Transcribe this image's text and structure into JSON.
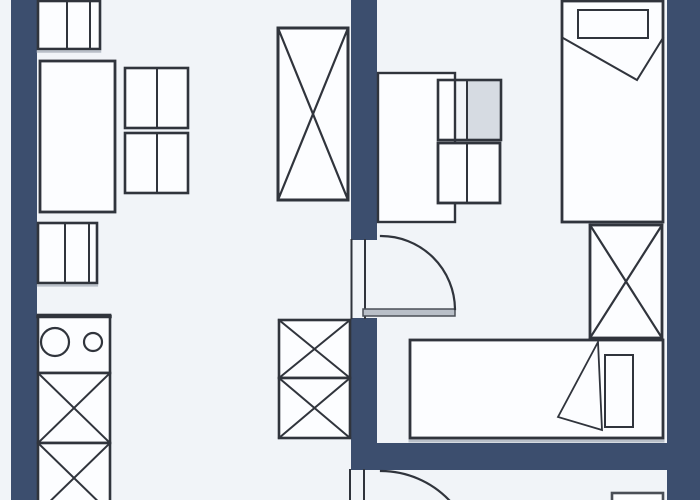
{
  "floorplan": {
    "canvas": {
      "width": 700,
      "height": 500
    },
    "palette": {
      "background": "#f1f4f8",
      "wall": "#3c4e6e",
      "line": "#30343c",
      "line_soft": "#4a4f57",
      "paper": "#fcfdff",
      "shade": "#b9bfc8",
      "cell_shade": "#d6dbe2"
    },
    "elements": [
      {
        "name": "wall-left",
        "kind": "rect",
        "x": 11,
        "y": 0,
        "w": 26,
        "h": 500,
        "fill": "wall",
        "stroke": "none"
      },
      {
        "name": "wall-middle-upper",
        "kind": "rect",
        "x": 351,
        "y": 0,
        "w": 26,
        "h": 240,
        "fill": "wall",
        "stroke": "none"
      },
      {
        "name": "wall-middle-lower",
        "kind": "rect",
        "x": 351,
        "y": 318,
        "w": 26,
        "h": 127,
        "fill": "wall",
        "stroke": "none"
      },
      {
        "name": "wall-bottom",
        "kind": "rect",
        "x": 351,
        "y": 443,
        "w": 349,
        "h": 27,
        "fill": "wall",
        "stroke": "none"
      },
      {
        "name": "wall-right",
        "kind": "rect",
        "x": 667,
        "y": 0,
        "w": 33,
        "h": 500,
        "fill": "wall",
        "stroke": "none"
      },
      {
        "name": "cabinet-top",
        "kind": "rect",
        "x": 38,
        "y": 1,
        "w": 62,
        "h": 48,
        "fill": "paper",
        "sw": 2.6
      },
      {
        "name": "cabinet-top-divider-1",
        "kind": "line",
        "x1": 67,
        "y1": 1,
        "x2": 67,
        "y2": 49,
        "sw": 2
      },
      {
        "name": "cabinet-top-divider-2",
        "kind": "line",
        "x1": 90,
        "y1": 1,
        "x2": 90,
        "y2": 49,
        "sw": 2
      },
      {
        "name": "cabinet-top-shadow",
        "kind": "line",
        "x1": 38,
        "y1": 51.5,
        "x2": 100,
        "y2": 51.5,
        "stroke": "shade",
        "sw": 2.5
      },
      {
        "name": "sofa-table-large",
        "kind": "rect",
        "x": 40,
        "y": 61,
        "w": 75,
        "h": 151,
        "fill": "paper",
        "sw": 2.8
      },
      {
        "name": "side-table-1",
        "kind": "rect",
        "x": 125,
        "y": 68,
        "w": 63,
        "h": 60,
        "fill": "paper",
        "sw": 2.6
      },
      {
        "name": "side-table-1-divider",
        "kind": "line",
        "x1": 157,
        "y1": 68,
        "x2": 157,
        "y2": 128,
        "sw": 2
      },
      {
        "name": "side-table-2",
        "kind": "rect",
        "x": 125,
        "y": 133,
        "w": 63,
        "h": 60,
        "fill": "paper",
        "sw": 2.6
      },
      {
        "name": "side-table-2-divider",
        "kind": "line",
        "x1": 157,
        "y1": 133,
        "x2": 157,
        "y2": 193,
        "sw": 2
      },
      {
        "name": "cabinet-mid",
        "kind": "rect",
        "x": 38,
        "y": 223,
        "w": 59,
        "h": 60,
        "fill": "paper",
        "sw": 2.6
      },
      {
        "name": "cabinet-mid-divider-1",
        "kind": "line",
        "x1": 65,
        "y1": 223,
        "x2": 65,
        "y2": 283,
        "sw": 2
      },
      {
        "name": "cabinet-mid-divider-2",
        "kind": "line",
        "x1": 89,
        "y1": 223,
        "x2": 89,
        "y2": 283,
        "sw": 2
      },
      {
        "name": "cabinet-mid-shadow",
        "kind": "line",
        "x1": 38,
        "y1": 285.5,
        "x2": 97,
        "y2": 285.5,
        "stroke": "shade",
        "sw": 2.2
      },
      {
        "name": "sink-counter",
        "kind": "rect",
        "x": 38,
        "y": 315,
        "w": 72,
        "h": 58,
        "fill": "paper",
        "sw": 2.6
      },
      {
        "name": "sink-counter-top-edge",
        "kind": "line",
        "x1": 38,
        "y1": 316.5,
        "x2": 110,
        "y2": 316.5,
        "sw": 3.5
      },
      {
        "name": "sink-basin-large",
        "kind": "circle",
        "cx": 55,
        "cy": 342,
        "r": 14,
        "sw": 2.2
      },
      {
        "name": "sink-basin-small",
        "kind": "circle",
        "cx": 93,
        "cy": 342,
        "r": 9,
        "sw": 2.2
      },
      {
        "name": "kitchen-unit-x1",
        "kind": "rect",
        "x": 38,
        "y": 373,
        "w": 72,
        "h": 70,
        "fill": "paper",
        "sw": 2.6
      },
      {
        "name": "kitchen-unit-x1-diag-a",
        "kind": "line",
        "x1": 38,
        "y1": 373,
        "x2": 110,
        "y2": 443,
        "sw": 2
      },
      {
        "name": "kitchen-unit-x1-diag-b",
        "kind": "line",
        "x1": 110,
        "y1": 373,
        "x2": 38,
        "y2": 443,
        "sw": 2
      },
      {
        "name": "kitchen-unit-x2",
        "kind": "rect",
        "x": 38,
        "y": 443,
        "w": 72,
        "h": 70,
        "fill": "paper",
        "sw": 2.6
      },
      {
        "name": "kitchen-unit-x2-diag-a",
        "kind": "line",
        "x1": 38,
        "y1": 443,
        "x2": 110,
        "y2": 513,
        "sw": 2
      },
      {
        "name": "kitchen-unit-x2-diag-b",
        "kind": "line",
        "x1": 110,
        "y1": 443,
        "x2": 38,
        "y2": 513,
        "sw": 2
      },
      {
        "name": "wardrobe-tall",
        "kind": "rect",
        "x": 278,
        "y": 28,
        "w": 70,
        "h": 172,
        "fill": "paper",
        "sw": 3
      },
      {
        "name": "wardrobe-tall-diag-a",
        "kind": "line",
        "x1": 278,
        "y1": 28,
        "x2": 348,
        "y2": 200,
        "sw": 2.2
      },
      {
        "name": "wardrobe-tall-diag-b",
        "kind": "line",
        "x1": 348,
        "y1": 28,
        "x2": 278,
        "y2": 200,
        "sw": 2.2
      },
      {
        "name": "storage-x-upper",
        "kind": "rect",
        "x": 279,
        "y": 320,
        "w": 71,
        "h": 58,
        "fill": "paper",
        "sw": 2.6
      },
      {
        "name": "storage-x-upper-diag-a",
        "kind": "line",
        "x1": 279,
        "y1": 320,
        "x2": 350,
        "y2": 378,
        "sw": 2
      },
      {
        "name": "storage-x-upper-diag-b",
        "kind": "line",
        "x1": 350,
        "y1": 320,
        "x2": 279,
        "y2": 378,
        "sw": 2
      },
      {
        "name": "storage-x-lower",
        "kind": "rect",
        "x": 279,
        "y": 378,
        "w": 71,
        "h": 60,
        "fill": "paper",
        "sw": 2.6
      },
      {
        "name": "storage-x-lower-diag-a",
        "kind": "line",
        "x1": 279,
        "y1": 378,
        "x2": 350,
        "y2": 438,
        "sw": 2
      },
      {
        "name": "storage-x-lower-diag-b",
        "kind": "line",
        "x1": 350,
        "y1": 378,
        "x2": 279,
        "y2": 438,
        "sw": 2
      },
      {
        "name": "door-1-jamb-left",
        "kind": "line",
        "x1": 351.5,
        "y1": 240,
        "x2": 351.5,
        "y2": 318,
        "sw": 2
      },
      {
        "name": "door-1-jamb-inner",
        "kind": "line",
        "x1": 365,
        "y1": 240,
        "x2": 365,
        "y2": 318,
        "sw": 2
      },
      {
        "name": "door-1-leaf",
        "kind": "rect",
        "x": 363,
        "y": 309,
        "w": 92,
        "h": 7,
        "fill": "shade",
        "stroke": "line_soft",
        "sw": 1.5
      },
      {
        "name": "door-1-swing-arc",
        "kind": "path",
        "d": "M 455 309 A 74 74 0 0 0 381 236",
        "sw": 2.2
      },
      {
        "name": "desk",
        "kind": "rect",
        "x": 378,
        "y": 73,
        "w": 77,
        "h": 149,
        "fill": "paper",
        "sw": 2.4
      },
      {
        "name": "desk-chair-upper-shade",
        "kind": "rect",
        "x": 467,
        "y": 81,
        "w": 33,
        "h": 58,
        "fill": "cell_shade",
        "stroke": "none"
      },
      {
        "name": "desk-chair-upper",
        "kind": "rect",
        "x": 438,
        "y": 80,
        "w": 63,
        "h": 60,
        "fill": "none",
        "sw": 2.6
      },
      {
        "name": "desk-chair-upper-divider",
        "kind": "line",
        "x1": 467,
        "y1": 80,
        "x2": 467,
        "y2": 140,
        "sw": 2
      },
      {
        "name": "desk-chair-lower",
        "kind": "rect",
        "x": 438,
        "y": 143,
        "w": 62,
        "h": 60,
        "fill": "paper",
        "sw": 2.8
      },
      {
        "name": "desk-chair-lower-divider",
        "kind": "line",
        "x1": 467,
        "y1": 143,
        "x2": 467,
        "y2": 203,
        "sw": 2
      },
      {
        "name": "bed-1",
        "kind": "rect",
        "x": 562,
        "y": 1,
        "w": 101,
        "h": 221,
        "fill": "paper",
        "sw": 2.8
      },
      {
        "name": "bed-1-pillow",
        "kind": "rect",
        "x": 578,
        "y": 10,
        "w": 70,
        "h": 28,
        "fill": "paper",
        "sw": 2
      },
      {
        "name": "bed-1-blanket-fold",
        "kind": "polyline",
        "points": "563,38 637,80 663,38",
        "sw": 2
      },
      {
        "name": "wardrobe-right",
        "kind": "rect",
        "x": 590,
        "y": 225,
        "w": 72,
        "h": 113,
        "fill": "paper",
        "sw": 2.8
      },
      {
        "name": "wardrobe-right-diag-a",
        "kind": "line",
        "x1": 590,
        "y1": 225,
        "x2": 662,
        "y2": 338,
        "sw": 2.2
      },
      {
        "name": "wardrobe-right-diag-b",
        "kind": "line",
        "x1": 662,
        "y1": 225,
        "x2": 590,
        "y2": 338,
        "sw": 2.2
      },
      {
        "name": "bed-2-shadow",
        "kind": "line",
        "x1": 410,
        "y1": 441,
        "x2": 663,
        "y2": 441,
        "stroke": "shade",
        "sw": 3
      },
      {
        "name": "bed-2",
        "kind": "rect",
        "x": 410,
        "y": 340,
        "w": 253,
        "h": 98,
        "fill": "paper",
        "sw": 2.8
      },
      {
        "name": "bed-2-pillow",
        "kind": "rect",
        "x": 605,
        "y": 355,
        "w": 28,
        "h": 72,
        "fill": "paper",
        "sw": 2
      },
      {
        "name": "bed-2-blanket-fold",
        "kind": "polygon",
        "points": "598,342 558,417 602,430",
        "fill": "paper",
        "sw": 1.8
      },
      {
        "name": "door-2-jamb-left",
        "kind": "line",
        "x1": 350,
        "y1": 470,
        "x2": 350,
        "y2": 500,
        "sw": 2
      },
      {
        "name": "door-2-jamb-inner",
        "kind": "line",
        "x1": 364,
        "y1": 470,
        "x2": 364,
        "y2": 500,
        "sw": 2
      },
      {
        "name": "door-2-swing-arc",
        "kind": "path",
        "d": "M 381 471 A 95 95 0 0 1 449 500",
        "sw": 2.2
      },
      {
        "name": "bottom-room-cabinet",
        "kind": "rect",
        "x": 612,
        "y": 493,
        "w": 51,
        "h": 30,
        "fill": "paper",
        "stroke": "line_soft",
        "sw": 2.6
      }
    ]
  }
}
